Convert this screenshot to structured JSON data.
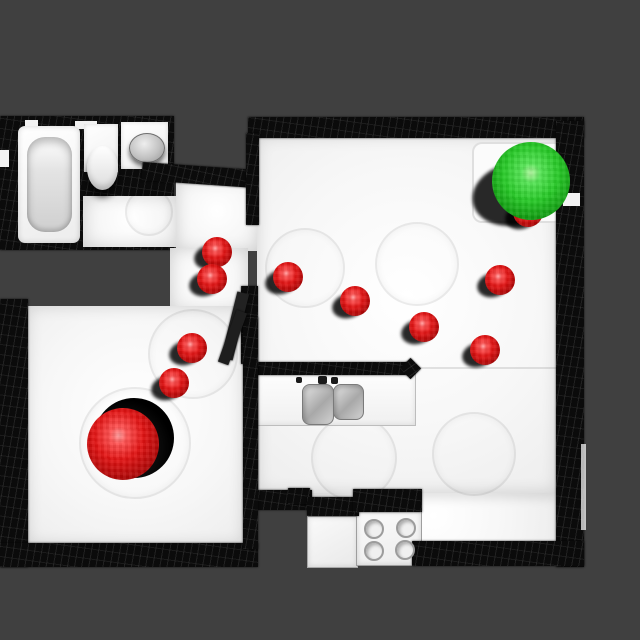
{
  "scene": {
    "description": "Top-down rendered mesh of an apartment used as a navigation map, with a red start sphere, red waypoint spheres and a green goal sphere",
    "background_color": "#404040",
    "wall_color": "#0b0b0b",
    "floor_color": "#f7f7f7"
  },
  "markers": {
    "waypoint_color": "#e51414",
    "waypoint_r": 15,
    "waypoints": [
      {
        "x": 174,
        "y": 383
      },
      {
        "x": 192,
        "y": 348
      },
      {
        "x": 217,
        "y": 252
      },
      {
        "x": 212,
        "y": 279
      },
      {
        "x": 288,
        "y": 277
      },
      {
        "x": 355,
        "y": 301
      },
      {
        "x": 424,
        "y": 327
      },
      {
        "x": 485,
        "y": 350
      },
      {
        "x": 500,
        "y": 280
      },
      {
        "x": 528,
        "y": 212
      }
    ],
    "start": {
      "label": "start",
      "x": 123,
      "y": 444,
      "r": 36,
      "color": "#e51414"
    },
    "goal": {
      "label": "goal",
      "x": 531,
      "y": 181,
      "r": 39,
      "color": "#27cb27"
    }
  }
}
